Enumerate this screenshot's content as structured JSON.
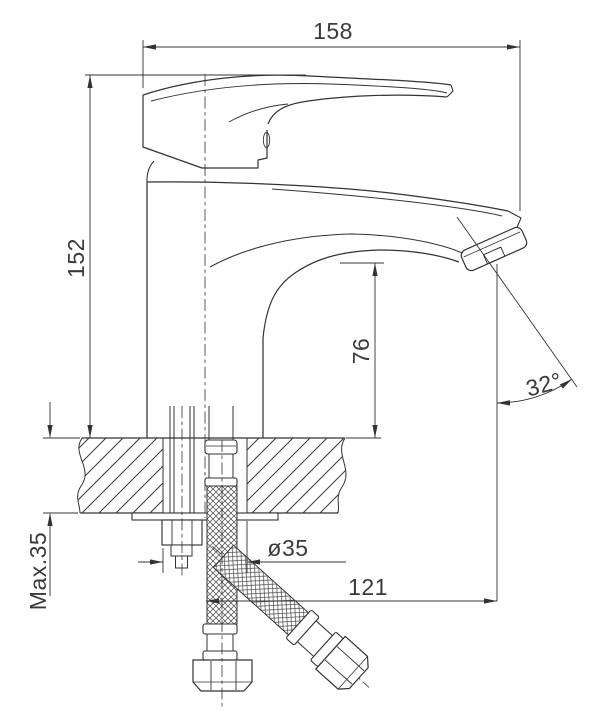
{
  "drawing": {
    "subject": "single-lever basin mixer faucet, side elevation with mounting cross-section",
    "dimension_labels": {
      "overall_length": "158",
      "overall_height": "152",
      "spout_outlet_height": "76",
      "spout_angle": "32°",
      "max_deck_thickness": "Max.35",
      "mounting_hole_diameter": "ø35",
      "spout_reach": "121"
    },
    "colors": {
      "line": "#333333",
      "background": "#ffffff"
    }
  }
}
